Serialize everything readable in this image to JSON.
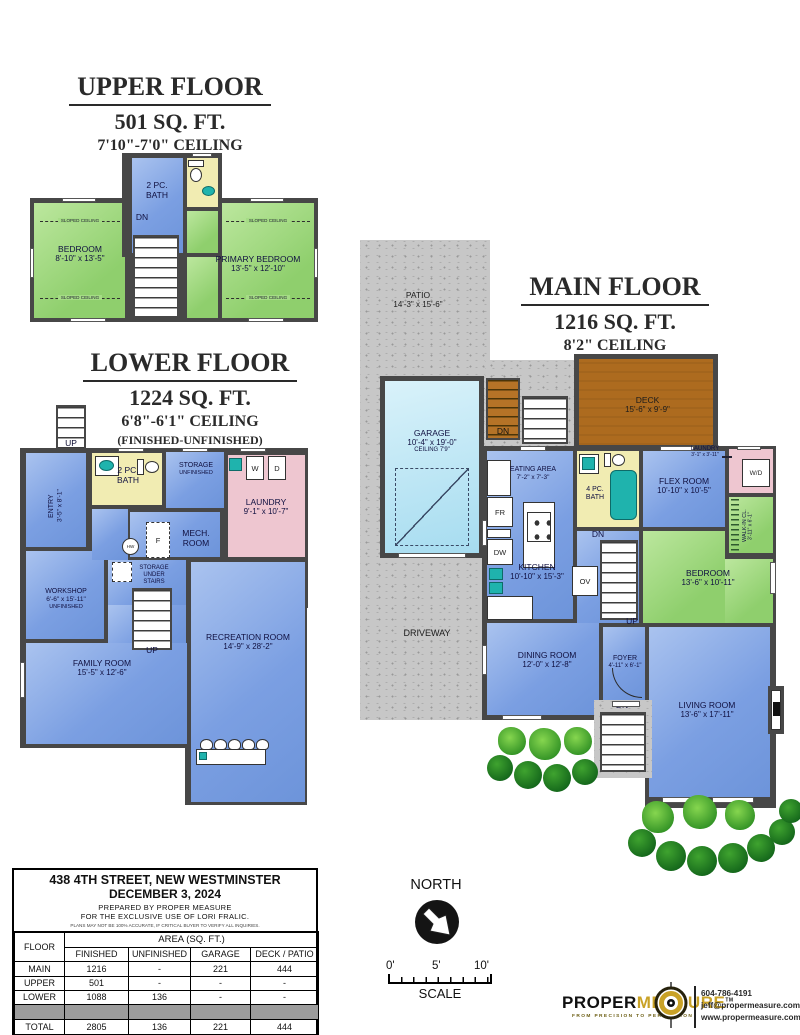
{
  "upper": {
    "title": "UPPER FLOOR",
    "area": "501 SQ. FT.",
    "ceiling": "7'10\"-7'0\" CEILING",
    "bath": {
      "l1": "2 PC.",
      "l2": "BATH"
    },
    "dn": "DN",
    "sloped": "SLOPED CEILING",
    "bedroom": {
      "name": "BEDROOM",
      "dims": "8'-10\" x 13'-5\""
    },
    "primary": {
      "name": "PRIMARY BEDROOM",
      "dims": "13'-5\" x 12'-10\""
    }
  },
  "lower": {
    "title": "LOWER FLOOR",
    "area": "1224 SQ. FT.",
    "ceiling": "6'8\"-6'1\" CEILING",
    "note": "(FINISHED-UNFINISHED)",
    "up": "UP",
    "entry": {
      "name": "ENTRY",
      "dims": "3'-5\" x 8'-1\""
    },
    "bath": {
      "l1": "2 PC.",
      "l2": "BATH"
    },
    "storage": {
      "name": "STORAGE",
      "dims": "UNFINISHED"
    },
    "w": "W",
    "d": "D",
    "laundry": {
      "name": "LAUNDRY",
      "dims": "9'-1\" x 10'-7\""
    },
    "mech": {
      "l1": "MECH.",
      "l2": "ROOM"
    },
    "f": "F",
    "hw": "HW",
    "workshop": {
      "name": "WORKSHOP",
      "dims": "6'-6\" x 15'-11\"",
      "note": "UNFINISHED"
    },
    "storage_under": {
      "l1": "STORAGE",
      "l2": "UNDER",
      "l3": "STAIRS"
    },
    "family": {
      "name": "FAMILY ROOM",
      "dims": "15'-5\" x 12'-6\""
    },
    "rec": {
      "name": "RECREATION ROOM",
      "dims": "14'-9\" x 28'-2\""
    }
  },
  "main": {
    "title": "MAIN FLOOR",
    "area": "1216 SQ. FT.",
    "ceiling": "8'2\" CEILING",
    "patio": {
      "name": "PATIO",
      "dims": "14'-3\" x 15'-6\""
    },
    "deck": {
      "name": "DECK",
      "dims": "15'-6\" x 9'-9\""
    },
    "garage": {
      "name": "GARAGE",
      "dims": "10'-4\" x 19'-0\"",
      "note": "CEILING 7'9\""
    },
    "driveway": "DRIVEWAY",
    "dn": "DN",
    "up": "UP",
    "eating": {
      "name": "EATING AREA",
      "dims": "7'-2\" x 7'-3\""
    },
    "kitchen": {
      "name": "KITCHEN",
      "dims": "10'-10\" x 15'-3\""
    },
    "bath": {
      "l1": "4 PC.",
      "l2": "BATH"
    },
    "flex": {
      "name": "FLEX ROOM",
      "dims": "10'-10\" x 10'-5\""
    },
    "laundry": {
      "name": "LAUNDRY",
      "dims": "3'-1\" x 3'-11\""
    },
    "wd": "W/D",
    "walkin": {
      "name": "WALK-IN CL.",
      "dims": "3'-11\" x 6'-1\""
    },
    "bedroom": {
      "name": "BEDROOM",
      "dims": "13'-6\" x 10'-11\""
    },
    "dining": {
      "name": "DINING ROOM",
      "dims": "12'-0\" x 12'-8\""
    },
    "foyer": {
      "name": "FOYER",
      "dims": "4'-11\" x 6'-1\""
    },
    "living": {
      "name": "LIVING ROOM",
      "dims": "13'-6\" x 17'-11\""
    },
    "fr": "FR",
    "dw": "DW",
    "ov": "OV"
  },
  "info": {
    "address": "438 4TH STREET, NEW WESTMINSTER",
    "date": "DECEMBER 3, 2024",
    "prepared_by": "PREPARED BY PROPER MEASURE",
    "exclusive": "FOR THE EXCLUSIVE USE OF LORI FRALIC.",
    "disclaimer": "PLANS MAY NOT BE 100% ACCURATE, IF CRITICAL BUYER TO VERIFY ALL INQUIRIES.",
    "floor_col": "FLOOR",
    "area_group": "AREA (SQ. FT.)",
    "cols": [
      "FINISHED",
      "UNFINISHED",
      "GARAGE",
      "DECK / PATIO"
    ],
    "rows": [
      {
        "floor": "MAIN",
        "finished": "1216",
        "unfinished": "-",
        "garage": "221",
        "deck": "444"
      },
      {
        "floor": "UPPER",
        "finished": "501",
        "unfinished": "-",
        "garage": "-",
        "deck": "-"
      },
      {
        "floor": "LOWER",
        "finished": "1088",
        "unfinished": "136",
        "garage": "-",
        "deck": "-"
      }
    ],
    "total_row": {
      "floor": "TOTAL",
      "finished": "2805",
      "unfinished": "136",
      "garage": "221",
      "deck": "444"
    },
    "total_label": "TOTAL SQ.FT. =",
    "total_value": "2,941",
    "total_suffix": "(FINISHED+UNFINISHED)"
  },
  "compass": {
    "label": "NORTH"
  },
  "scale": {
    "t0": "0'",
    "t5": "5'",
    "t10": "10'",
    "label": "SCALE"
  },
  "logo": {
    "brand1": "PROPER",
    "brand2": "MEASURE",
    "tm": "TM",
    "tagline": "FROM PRECISION TO PERFECTION",
    "phone": "604-786-4191",
    "email": "jeff@propermeasure.com",
    "website": "www.propermeasure.com"
  },
  "colors": {
    "room_blue": "#7ba1e4",
    "room_green": "#9ad578",
    "bath_yellow": "#f1ecb2",
    "laundry_pink": "#eec6d0",
    "deck_brown": "#ad6b1f",
    "patio_gray": "#c7c7c7",
    "wall_gray": "#474747",
    "fixture_teal": "#1fb3ad",
    "brand_gold": "#c9a227"
  }
}
